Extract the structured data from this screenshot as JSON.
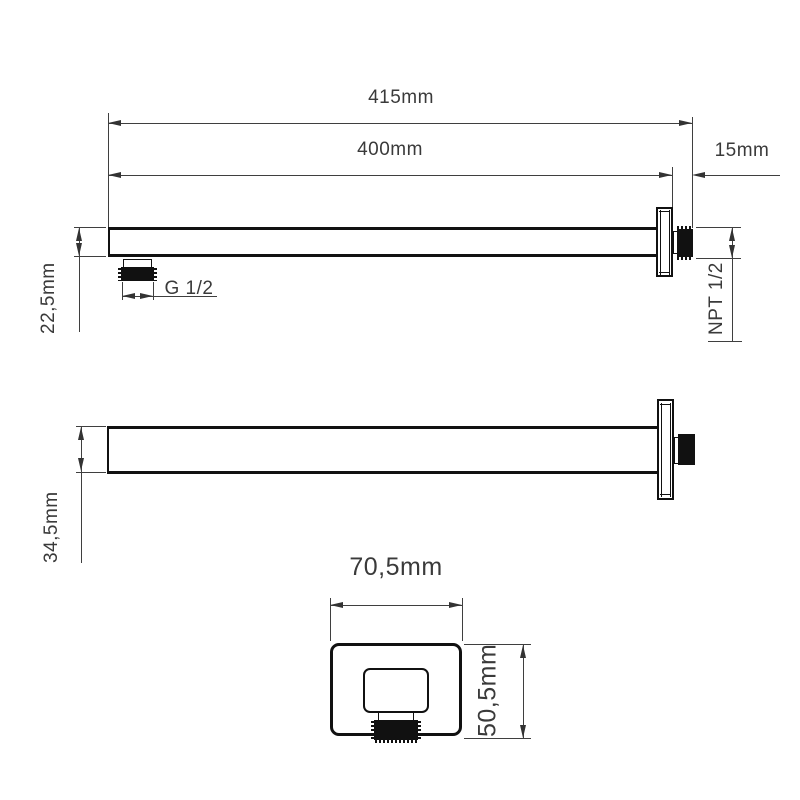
{
  "labels": {
    "overall_length": "415mm",
    "arm_length": "400mm",
    "wall_clearance": "15mm",
    "arm_height": "22,5mm",
    "outlet_thread": "G 1/2",
    "inlet_thread": "NPT 1/2",
    "arm_width": "34,5mm",
    "escutcheon_width": "70,5mm",
    "escutcheon_height": "50,5mm"
  },
  "colors": {
    "background": "#ffffff",
    "part_outline": "#111111",
    "dimension_line": "#3f3f3f",
    "text": "#3a3a3a"
  }
}
